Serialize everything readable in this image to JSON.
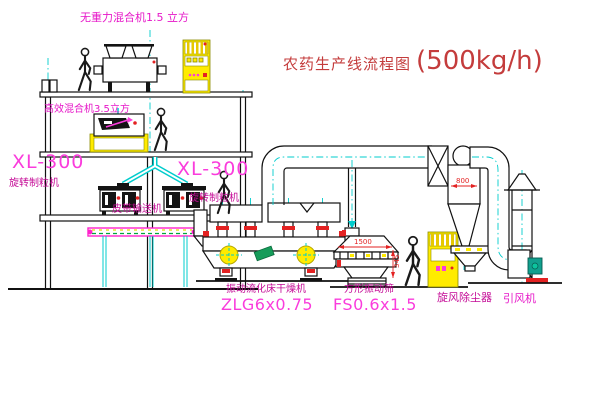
{
  "title": {
    "text": "农药生产线流程图",
    "capacity": "(500kg/h)"
  },
  "labels": {
    "top_mixer": "无重力混合机1.5 立方",
    "mixer_3f": "高效混合机3.5立方",
    "granulator_left": {
      "model": "XL-300",
      "name": "旋转制粒机"
    },
    "granulator_mid": {
      "model": "XL-300",
      "name": "旋转制粒机"
    },
    "belt_conveyor": "皮带输送机",
    "dryer": {
      "name": "振动流化床干燥机",
      "model": "ZLG6x0.75"
    },
    "sieve": {
      "name": "方形振动筛",
      "model": "FS0.6x1.5"
    },
    "cyclone": "旋风除尘器",
    "fan": "引风机"
  },
  "dimensions": {
    "sieve_length": "1500",
    "sieve_height": "345",
    "cyclone_width": "800"
  },
  "colors": {
    "magenta_bright": "#fa3cdc",
    "magenta_dark": "#c40a96",
    "title_red": "#c43c3c",
    "line_cyan": "#00cccc",
    "machine_yellow": "#ffeb00",
    "alert_red": "#e32222",
    "motor_teal": "#12a08e",
    "belt_green": "#00a53c"
  }
}
